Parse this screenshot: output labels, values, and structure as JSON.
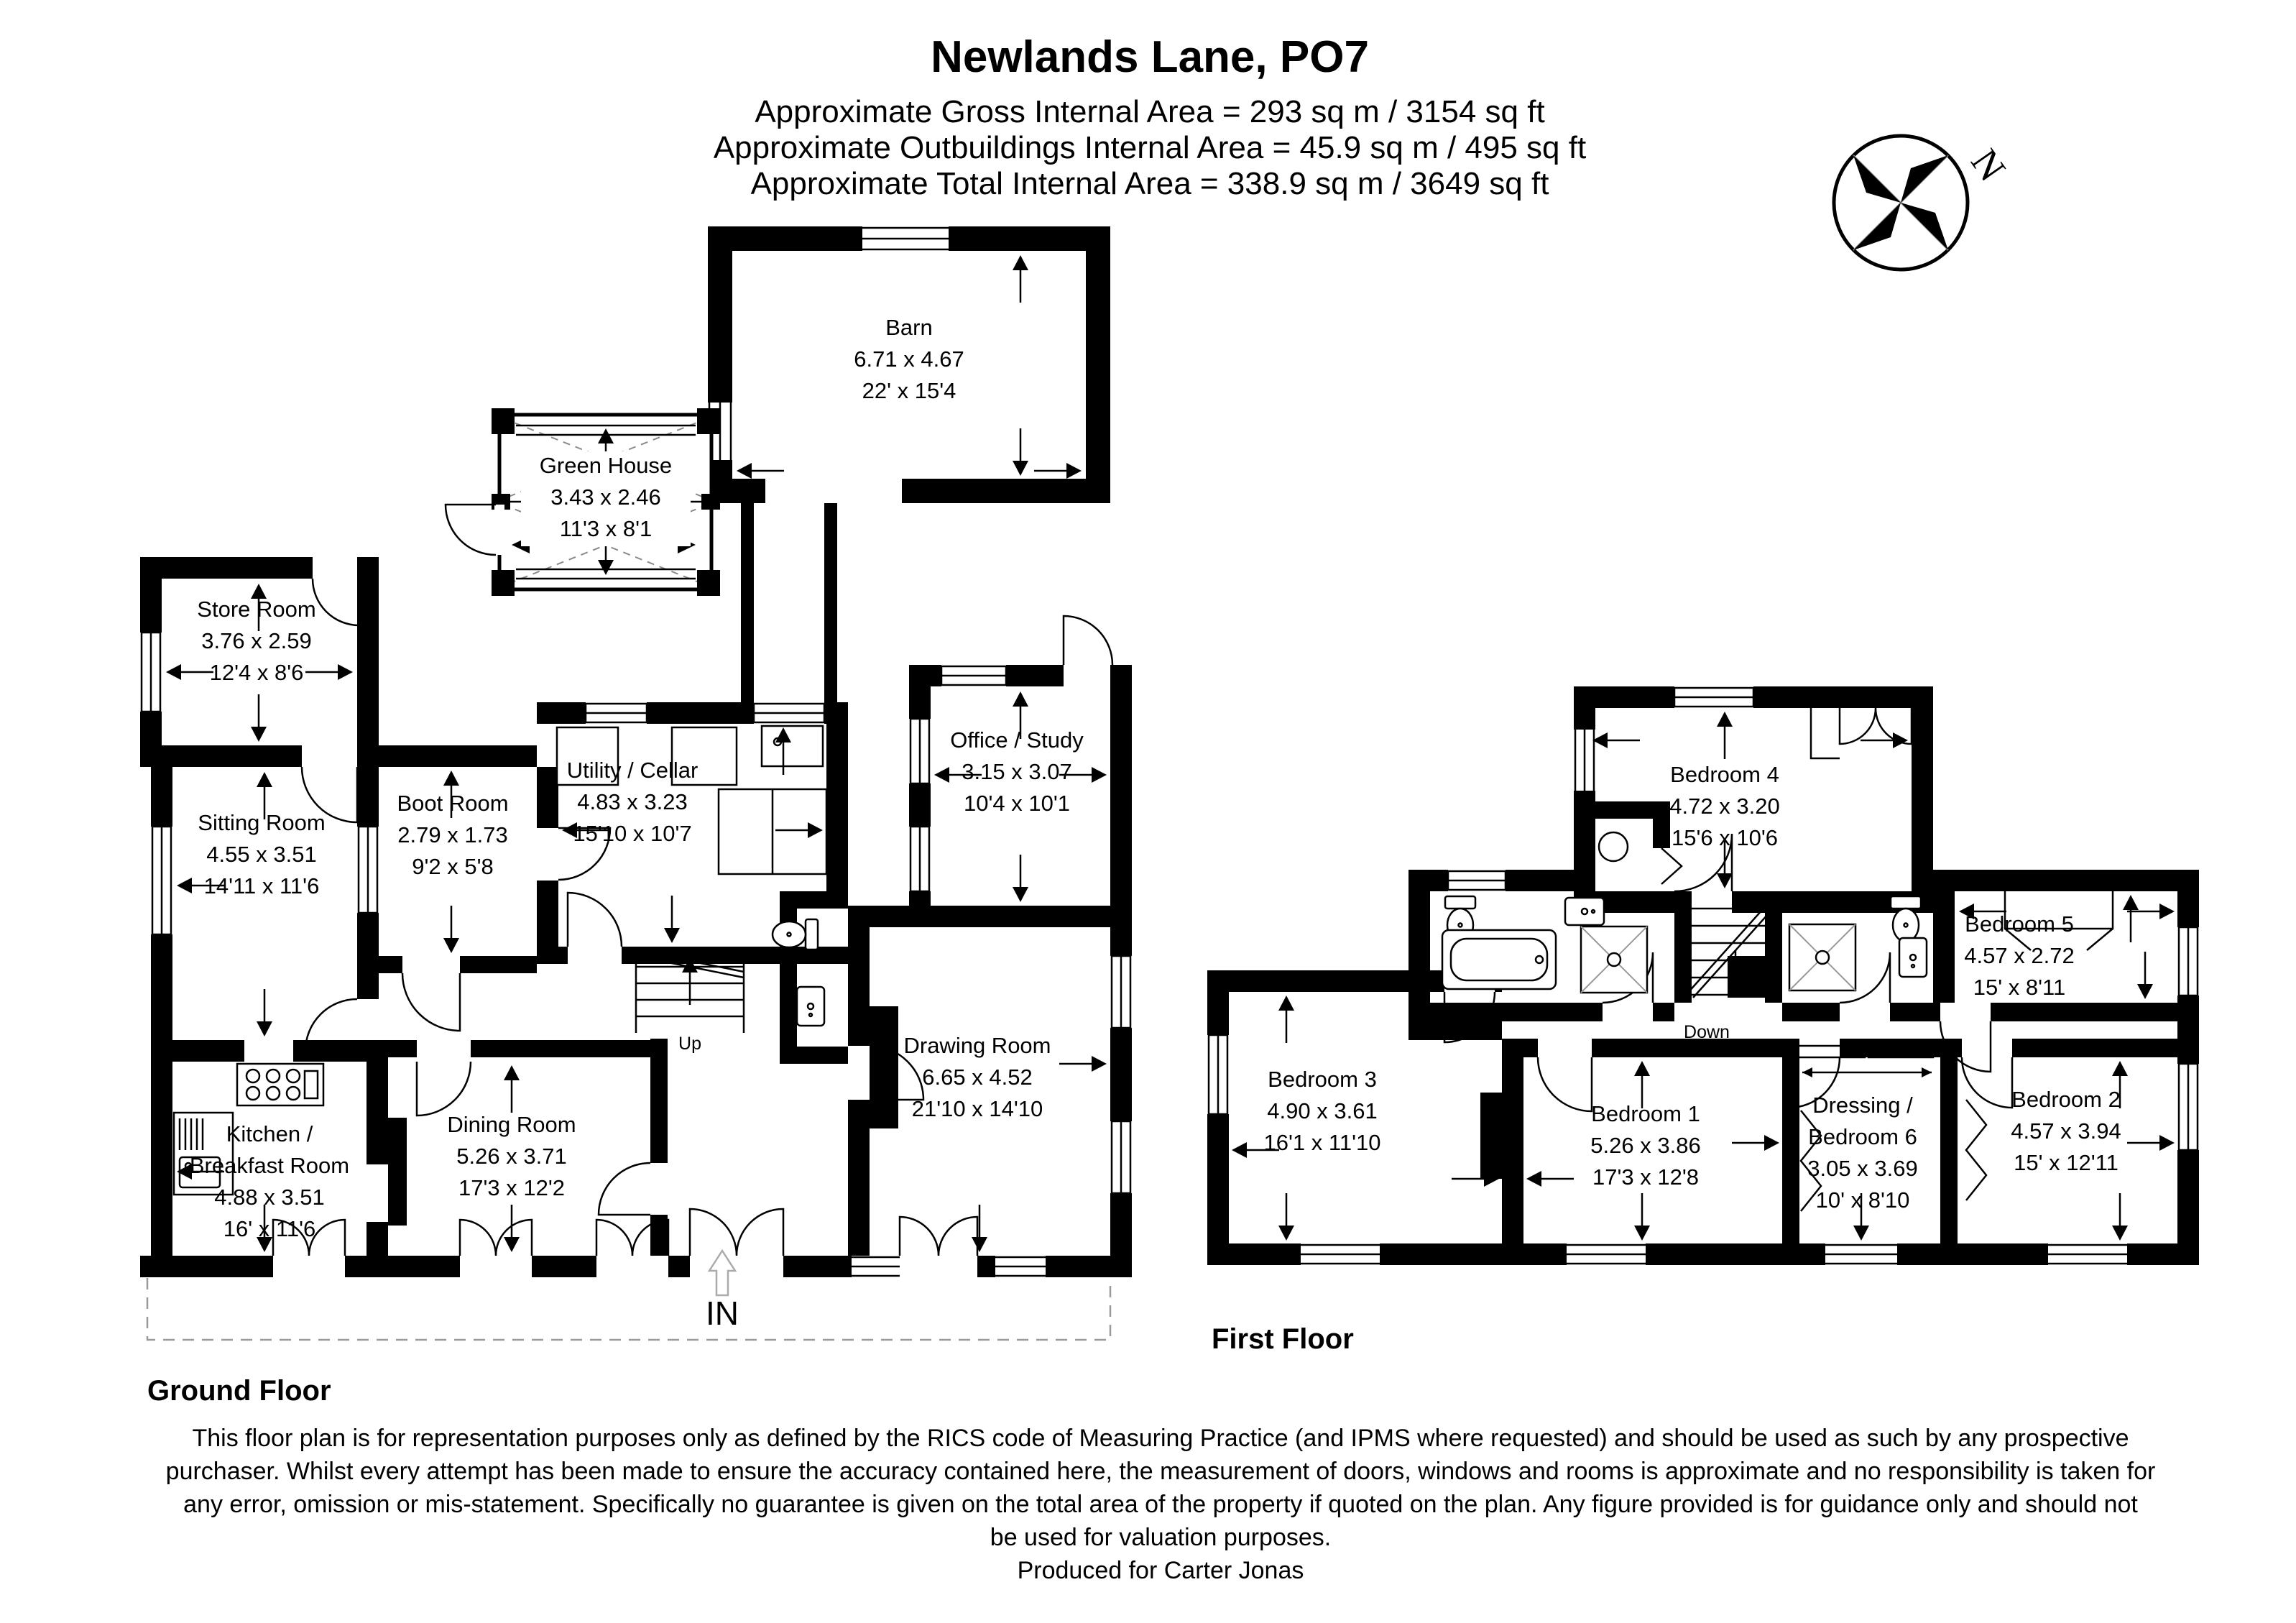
{
  "header": {
    "title": "Newlands Lane, PO7",
    "lines": [
      "Approximate Gross Internal Area = 293 sq m / 3154 sq ft",
      "Approximate Outbuildings Internal Area = 45.9 sq m / 495 sq ft",
      "Approximate Total Internal Area = 338.9 sq m / 3649 sq ft"
    ]
  },
  "compass": {
    "north_label": "N"
  },
  "floor_labels": {
    "ground": "Ground Floor",
    "first": "First Floor"
  },
  "annotations": {
    "entrance": "IN",
    "stairs_up": "Up",
    "stairs_down": "Down"
  },
  "rooms": {
    "barn": {
      "name": "Barn",
      "metric": "6.71 x 4.67",
      "imperial": "22' x 15'4"
    },
    "greenhouse": {
      "name": "Green House",
      "metric": "3.43 x 2.46",
      "imperial": "11'3 x 8'1"
    },
    "store": {
      "name": "Store Room",
      "metric": "3.76 x 2.59",
      "imperial": "12'4 x 8'6"
    },
    "sitting": {
      "name": "Sitting Room",
      "metric": "4.55 x 3.51",
      "imperial": "14'11 x 11'6"
    },
    "boot": {
      "name": "Boot Room",
      "metric": "2.79 x 1.73",
      "imperial": "9'2 x 5'8"
    },
    "utility": {
      "name": "Utility / Cellar",
      "metric": "4.83 x 3.23",
      "imperial": "15'10 x 10'7"
    },
    "office": {
      "name": "Office / Study",
      "metric": "3.15 x 3.07",
      "imperial": "10'4 x 10'1"
    },
    "kitchen": {
      "name_line1": "Kitchen /",
      "name_line2": "Breakfast Room",
      "metric": "4.88 x 3.51",
      "imperial": "16' x 11'6"
    },
    "dining": {
      "name": "Dining Room",
      "metric": "5.26 x 3.71",
      "imperial": "17'3 x 12'2"
    },
    "drawing": {
      "name": "Drawing Room",
      "metric": "6.65 x 4.52",
      "imperial": "21'10 x 14'10"
    },
    "bedroom4": {
      "name": "Bedroom 4",
      "metric": "4.72 x 3.20",
      "imperial": "15'6 x 10'6"
    },
    "bedroom5": {
      "name": "Bedroom 5",
      "metric": "4.57 x 2.72",
      "imperial": "15' x 8'11"
    },
    "bedroom3": {
      "name": "Bedroom 3",
      "metric": "4.90 x 3.61",
      "imperial": "16'1 x 11'10"
    },
    "bedroom1": {
      "name": "Bedroom 1",
      "metric": "5.26 x 3.86",
      "imperial": "17'3 x 12'8"
    },
    "dressing6": {
      "name_line1": "Dressing /",
      "name_line2": "Bedroom 6",
      "metric": "3.05 x 3.69",
      "imperial": "10' x 8'10"
    },
    "bedroom2": {
      "name": "Bedroom 2",
      "metric": "4.57 x 3.94",
      "imperial": "15' x 12'11"
    }
  },
  "footer": {
    "disclaimer": [
      "This floor plan is for representation purposes only as defined by the RICS code of Measuring Practice (and IPMS where requested) and should be used as such by any prospective",
      "purchaser. Whilst every attempt has been made to ensure the accuracy contained here, the measurement of doors, windows and rooms is approximate and no responsibility is taken for",
      "any error, omission or mis-statement. Specifically no guarantee is given on the total area of the property if quoted on the plan. Any figure provided is for guidance only and should not",
      "be used for valuation purposes.",
      "Produced for Carter Jonas"
    ]
  }
}
